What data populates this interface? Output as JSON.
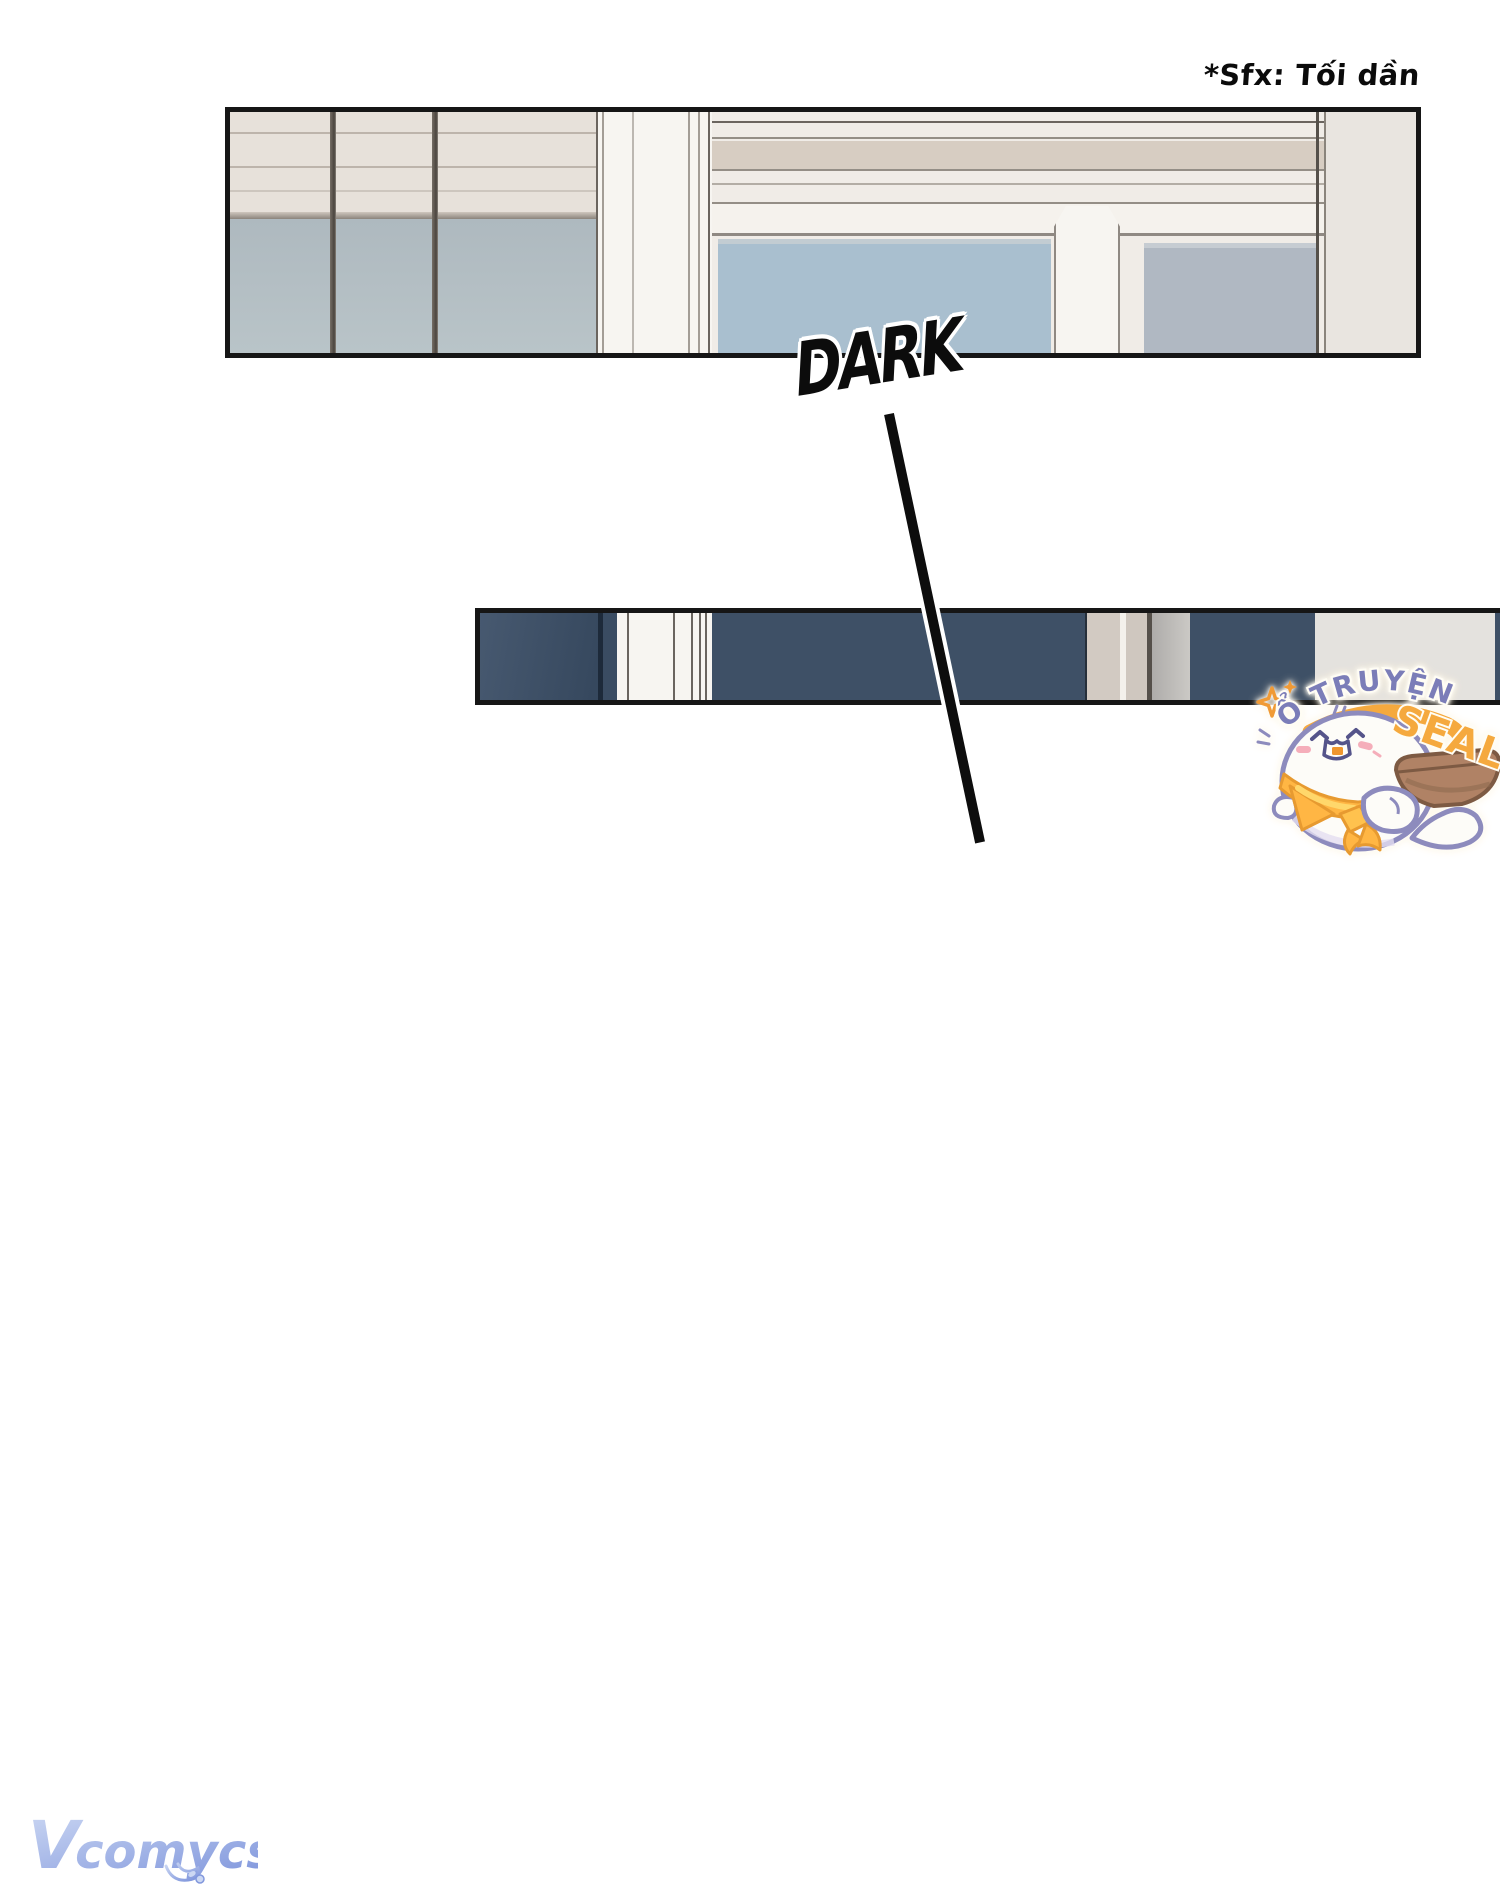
{
  "caption": {
    "text": "*Sfx: Tối dần"
  },
  "sound_effect": {
    "text": "DARK"
  },
  "watermarks": {
    "seal": {
      "arc_text": "Ổ TRUYỆN",
      "main_text": "SEAL"
    },
    "publisher": {
      "initial": "V",
      "rest": "comycs"
    }
  },
  "colors": {
    "page_bg": "#ffffff",
    "panel_border": "#161616",
    "ink": "#0d0d0d",
    "scene_cream": "#f0ece7",
    "blinds_beige": "#e7e1da",
    "blind_line": "#bdb4ab",
    "sill_dark": "#8b847c",
    "pillar_white": "#f7f5f1",
    "trim_line": "#948e86",
    "ceiling_line": "#6b655f",
    "tan_band": "#d7cdc2",
    "glass_blue": "#a9bfcf",
    "glass_grey": "#b0b8c2",
    "wall_beige": "#e9e5e0",
    "navy": "#3e5066",
    "stripe_white": "#f7f5f1",
    "stripe_beige": "#d2cac2",
    "panel_light_end": "#e4e2de",
    "seal_purple": "#7b7db8",
    "seal_orange": "#f5a93e",
    "seal_outline": "#8d8bbd",
    "seal_face": "#55548a",
    "blush_pink": "#f5aeba",
    "bandana_orange": "#ffb644",
    "bandana_deep": "#e79a30",
    "bowl_brown": "#b08265",
    "bowl_edge": "#7d5a43",
    "logo_light": "#ccd8f3",
    "logo_dark": "#8298dd"
  }
}
